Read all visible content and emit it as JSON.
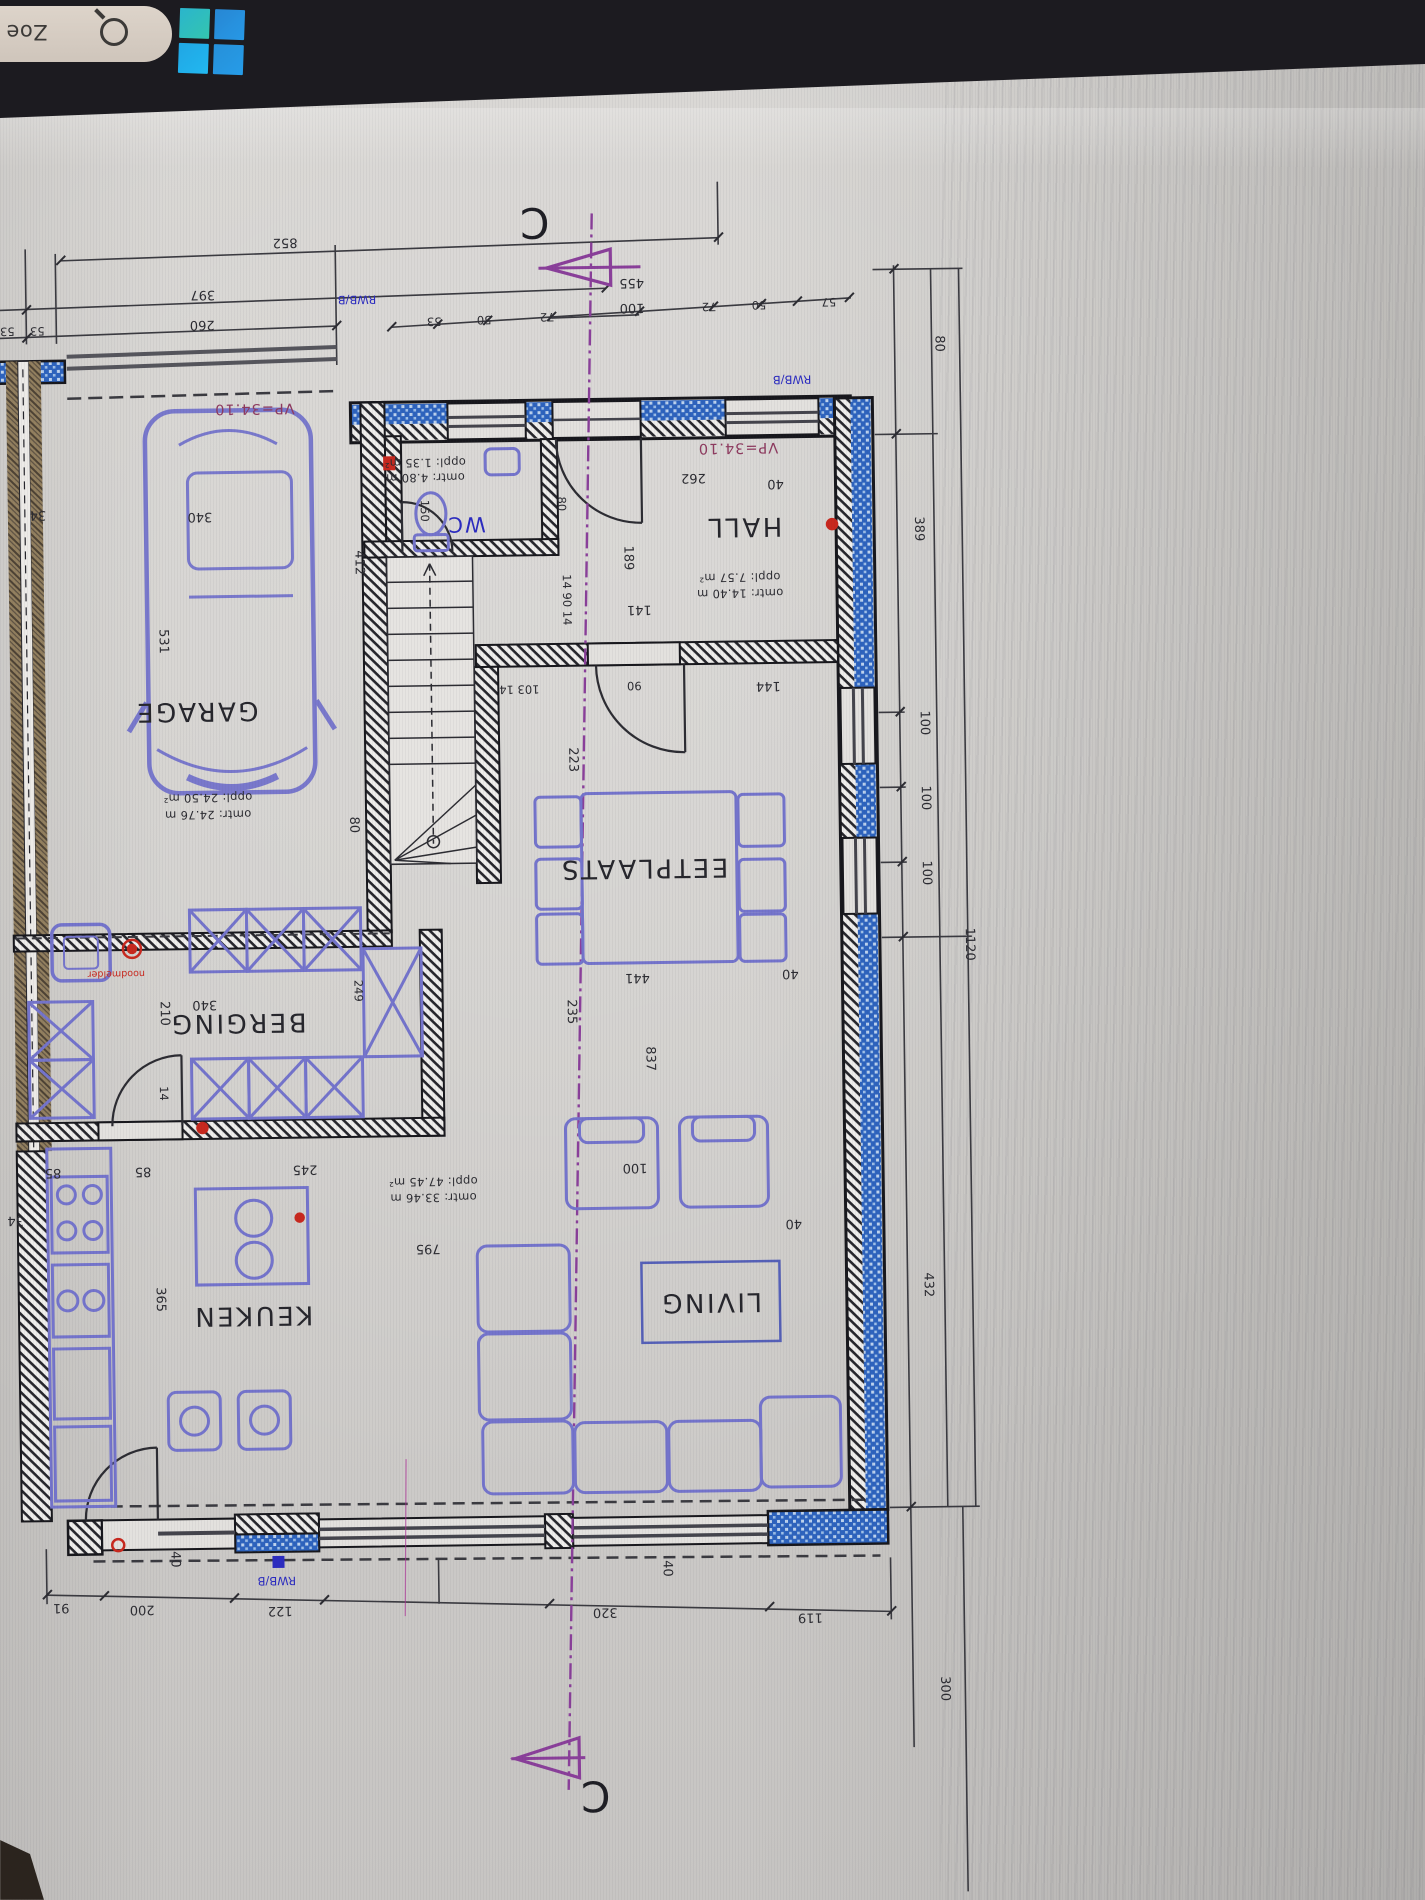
{
  "taskbar": {
    "search_text": "Zoe",
    "logo_name": "windows-logo"
  },
  "section": {
    "letter_top": "C",
    "letter_bottom": "C"
  },
  "labels": {
    "garage": "GARAGE",
    "garage_area": "oppl: 24.50 m²",
    "garage_per": "omtr: 24.76 m",
    "berging": "BERGING",
    "keuken": "KEUKEN",
    "living": "LIVING",
    "living_area": "oppl: 47.45 m²",
    "living_per": "omtr: 33.46 m",
    "eetplaats": "EETPLAATS",
    "hall": "HALL",
    "hall_area": "oppl: 7.57 m²",
    "hall_per": "omtr: 14.40 m",
    "wc": "WC",
    "wc_area": "oppl: 1.35 m²",
    "wc_per": "omtr: 4.80 m",
    "vp_left": "VP=34.10",
    "vp_right": "VP=34.10",
    "rwb_top_left": "RWB/B",
    "rwb_top_right": "RWB/B",
    "rwb_bottom": "RWB/B",
    "detector": "noodmelder"
  },
  "dims": {
    "top": [
      "852",
      "397",
      "53",
      "53",
      "260",
      "455",
      "100",
      "53",
      "50",
      "72",
      "72",
      "50",
      "57"
    ],
    "right": [
      "80",
      "389",
      "100",
      "100",
      "100",
      "1120",
      "432",
      "300"
    ],
    "bottom": [
      "40",
      "40",
      "91",
      "200",
      "122",
      "320",
      "119"
    ],
    "left": [
      "34",
      "531",
      "340",
      "412",
      "80",
      "210",
      "340",
      "14",
      "249",
      "34",
      "85",
      "85",
      "245",
      "365"
    ],
    "inner": [
      "150",
      "80",
      "14 90 14",
      "262",
      "40",
      "189",
      "141",
      "144",
      "90",
      "103 14",
      "223",
      "235",
      "441",
      "837",
      "40",
      "100",
      "795",
      "40"
    ]
  },
  "colors": {
    "wall_insulation_blue": "#2d63be",
    "furniture_blue": "#7474cc",
    "section_purple": "#8a3f9a",
    "rwb_blue": "#2b2bc0",
    "vp_maroon": "#8e3a5f",
    "marker_red": "#c8281e",
    "taskbar_dark": "#1c1b20",
    "screen_gray": "#d3d1ce"
  }
}
